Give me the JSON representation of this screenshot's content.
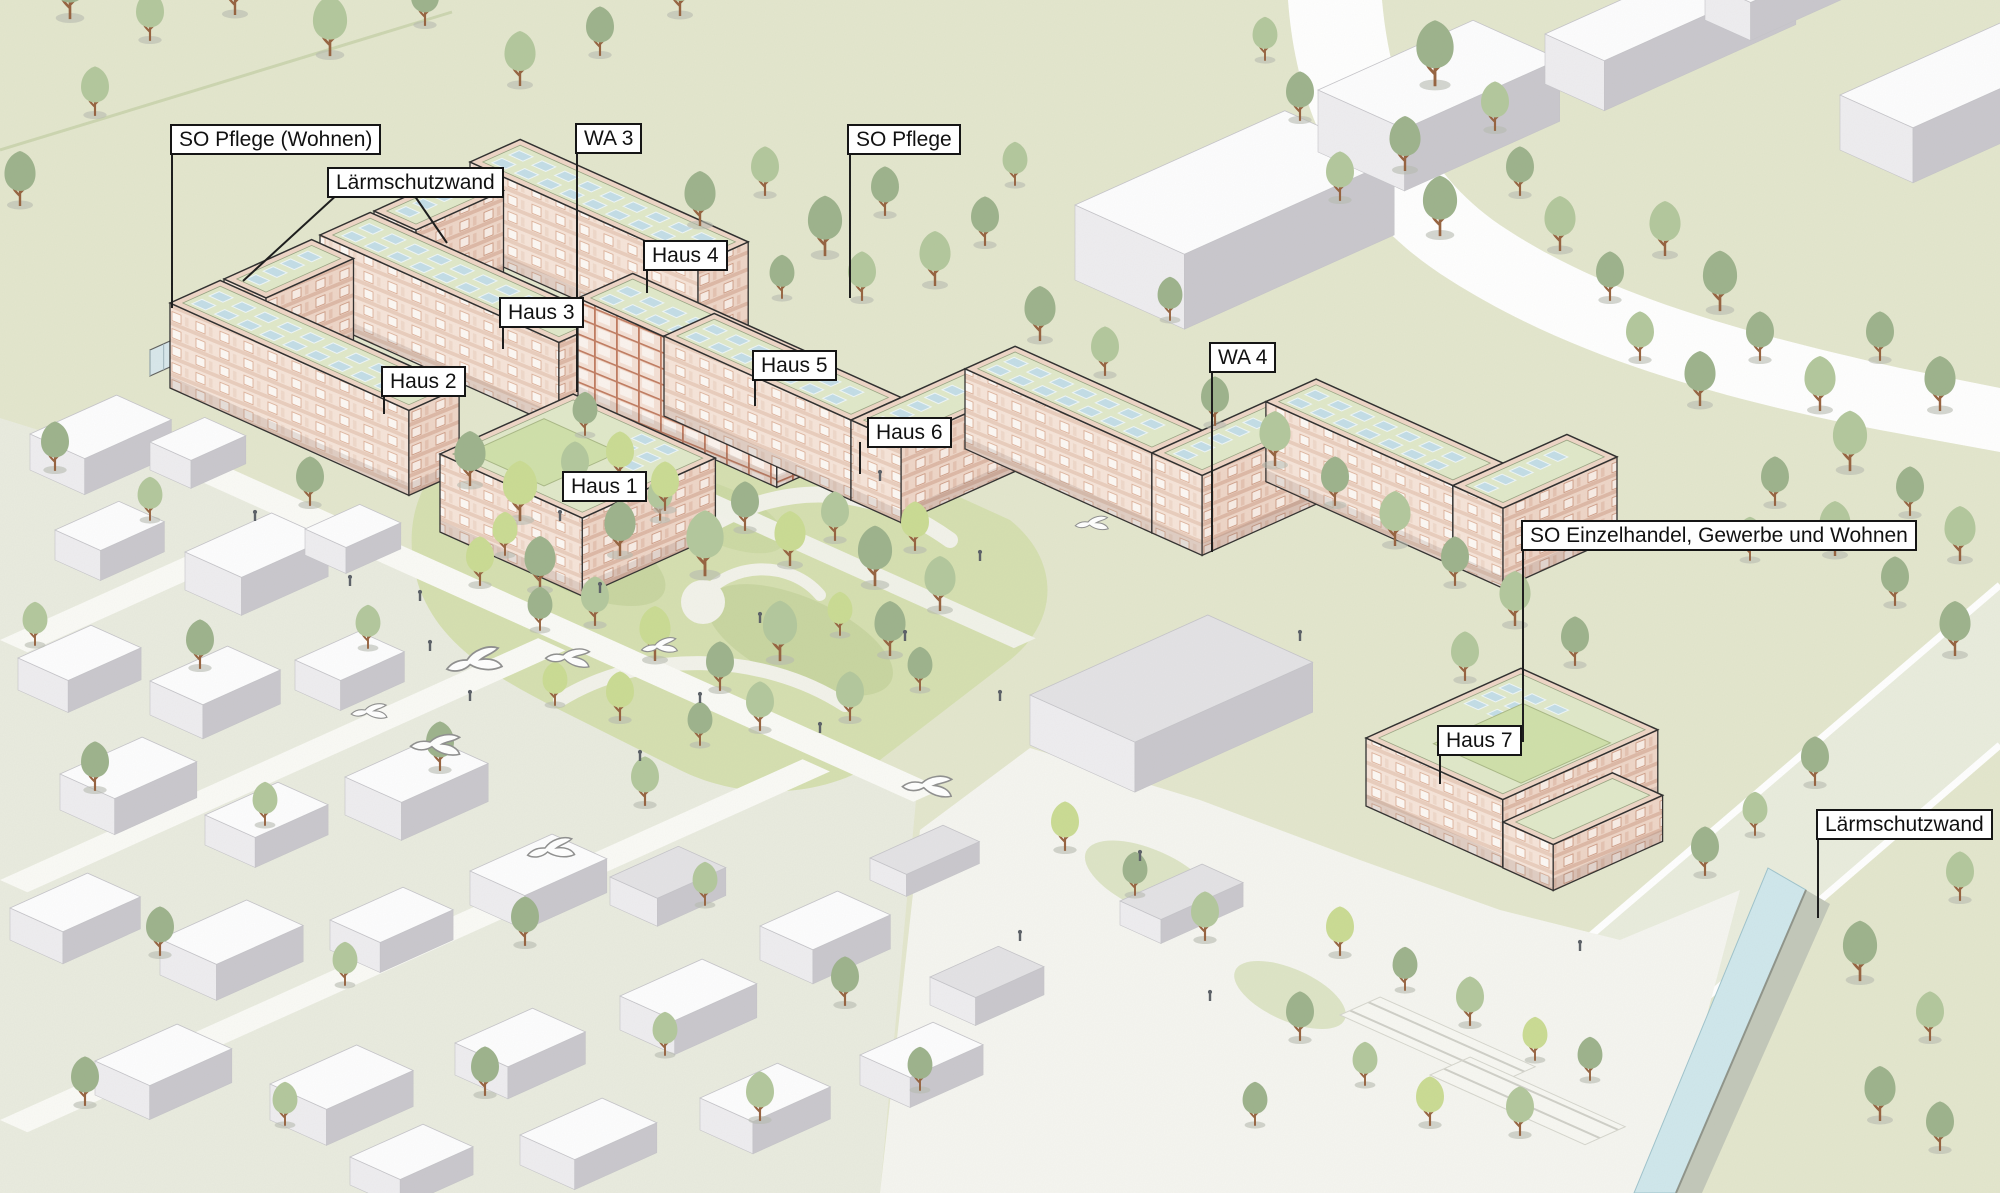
{
  "labels": [
    {
      "id": "so-pflege-wohnen",
      "kind": "zone",
      "text": "SO Pflege (Wohnen)"
    },
    {
      "id": "laermschutzwand-left",
      "kind": "annotation",
      "text": "Lärmschutzwand"
    },
    {
      "id": "wa-3",
      "kind": "zone",
      "text": "WA 3"
    },
    {
      "id": "so-pflege",
      "kind": "zone",
      "text": "SO Pflege"
    },
    {
      "id": "haus-4",
      "kind": "building",
      "text": "Haus 4"
    },
    {
      "id": "haus-3",
      "kind": "building",
      "text": "Haus 3"
    },
    {
      "id": "haus-2",
      "kind": "building",
      "text": "Haus 2"
    },
    {
      "id": "haus-5",
      "kind": "building",
      "text": "Haus 5"
    },
    {
      "id": "haus-6",
      "kind": "building",
      "text": "Haus 6"
    },
    {
      "id": "haus-1",
      "kind": "building",
      "text": "Haus 1"
    },
    {
      "id": "wa-4",
      "kind": "zone",
      "text": "WA 4"
    },
    {
      "id": "so-einzelhandel",
      "kind": "zone",
      "text": "SO Einzelhandel, Gewerbe und Wohnen"
    },
    {
      "id": "haus-7",
      "kind": "building",
      "text": "Haus 7"
    },
    {
      "id": "laermschutzwand-right",
      "kind": "annotation",
      "text": "Lärmschutzwand"
    }
  ],
  "colors": {
    "grass": "#e3e6cd",
    "park_grass": "#d5dfb0",
    "road": "#fafaf6",
    "facade_light": "#f6e4d9",
    "facade_shade": "#eed5c7",
    "window_frame": "#c4836b",
    "roof_border": "#eed5c6",
    "roof_green": "#e0e8c9",
    "solar_panel": "#c3dde7",
    "glass_wall": "#d8e8ee",
    "water_channel": "#cfe7ec",
    "context_side": "#c9c7cd",
    "tree_dark": "#9db28c",
    "tree_mid": "#b3c79c",
    "tree_light": "#cadb93",
    "label_border": "#151515"
  }
}
